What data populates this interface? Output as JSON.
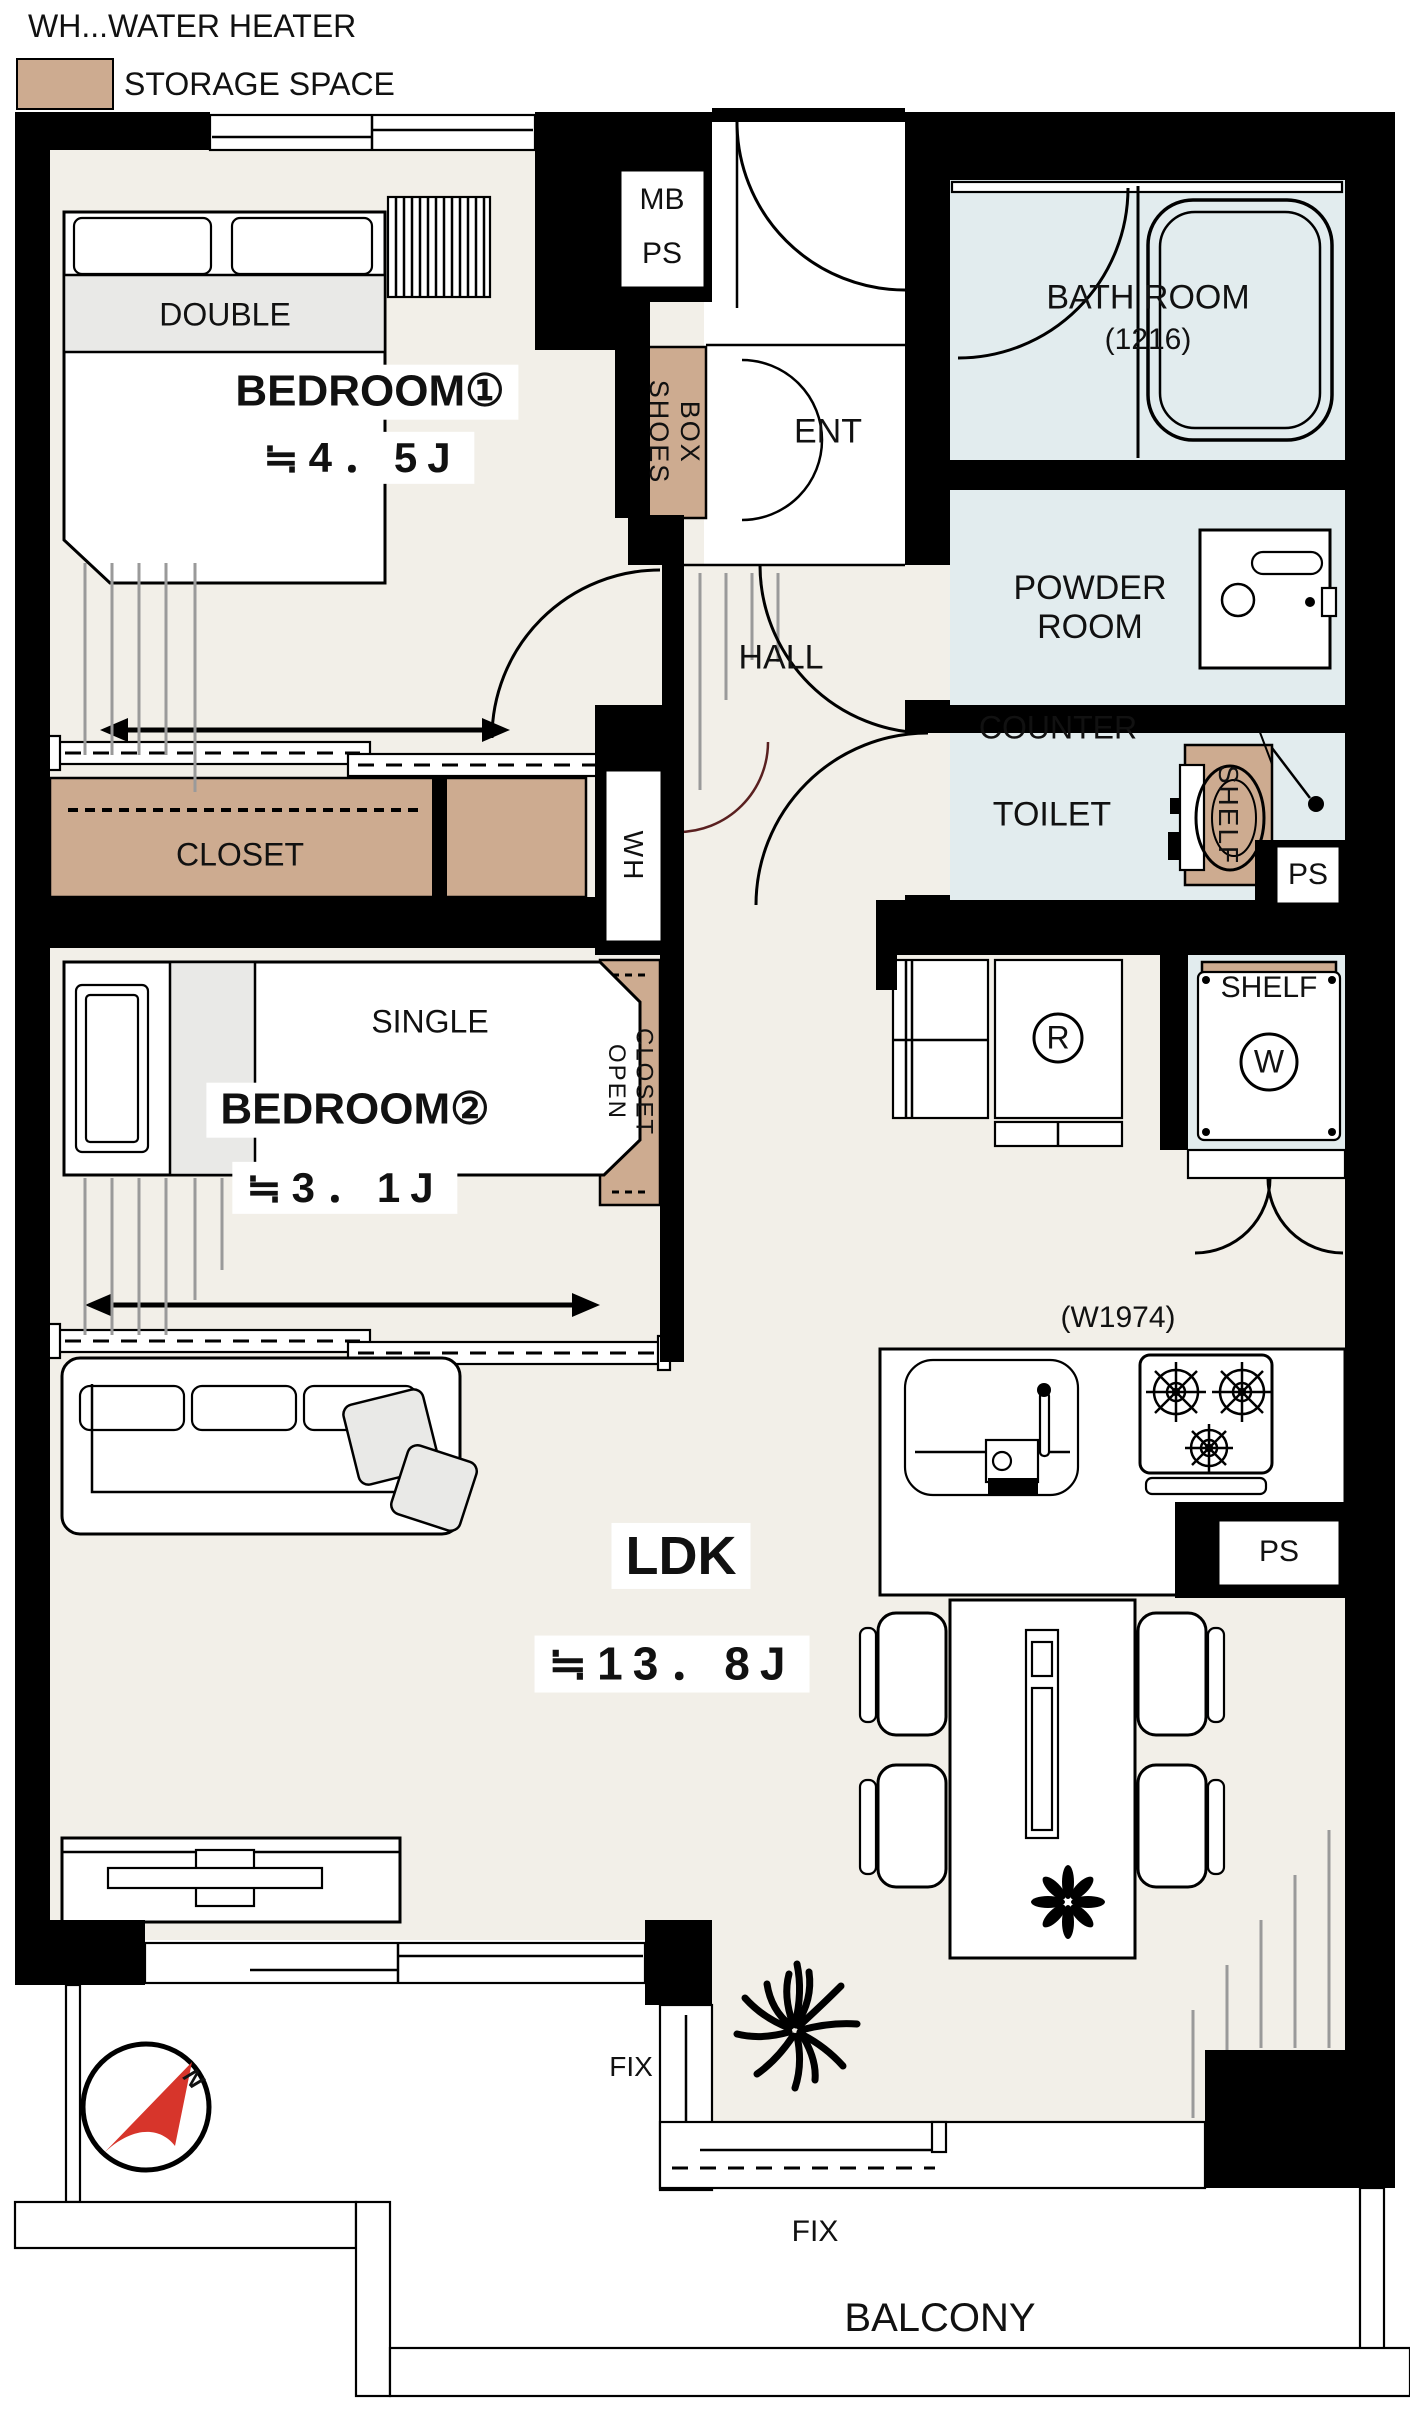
{
  "colors": {
    "wall": "#000000",
    "floor": "#f2efe8",
    "water": "#e2ecee",
    "storage": "#cdab90",
    "furniture_gray": "#e9e9e7",
    "compass_red": "#d7352b",
    "line_gray": "#9a9a9a",
    "door_red": "#5a2020"
  },
  "legend": {
    "water_heater": "WH...WATER HEATER",
    "storage_space": "STORAGE SPACE"
  },
  "rooms": {
    "bedroom1": {
      "name": "BEDROOM①",
      "size": "≒4．5J"
    },
    "bedroom2": {
      "name": "BEDROOM②",
      "size": "≒3．1J"
    },
    "ldk": {
      "name": "LDK",
      "size": "≒13．8J"
    },
    "bathroom": {
      "name": "BATH ROOM",
      "size": "(1216)"
    },
    "powder_room": {
      "name": "POWDER ROOM"
    },
    "toilet": {
      "name": "TOILET"
    },
    "hall": {
      "name": "HALL"
    },
    "entrance": {
      "name": "ENT"
    },
    "balcony": {
      "name": "BALCONY"
    }
  },
  "labels": {
    "mb": "MB",
    "ps": "PS",
    "wh": "WH",
    "shoes_box": "SHOES\nBOX",
    "closet": "CLOSET",
    "open_closet": "OPEN\nCLOSET",
    "shelf": "SHELF",
    "counter": "COUNTER",
    "double_bed": "DOUBLE",
    "single_bed": "SINGLE",
    "refrigerator": "R",
    "washer": "W",
    "kitchen_width": "(W1974)",
    "fix": "FIX",
    "north": "N"
  }
}
